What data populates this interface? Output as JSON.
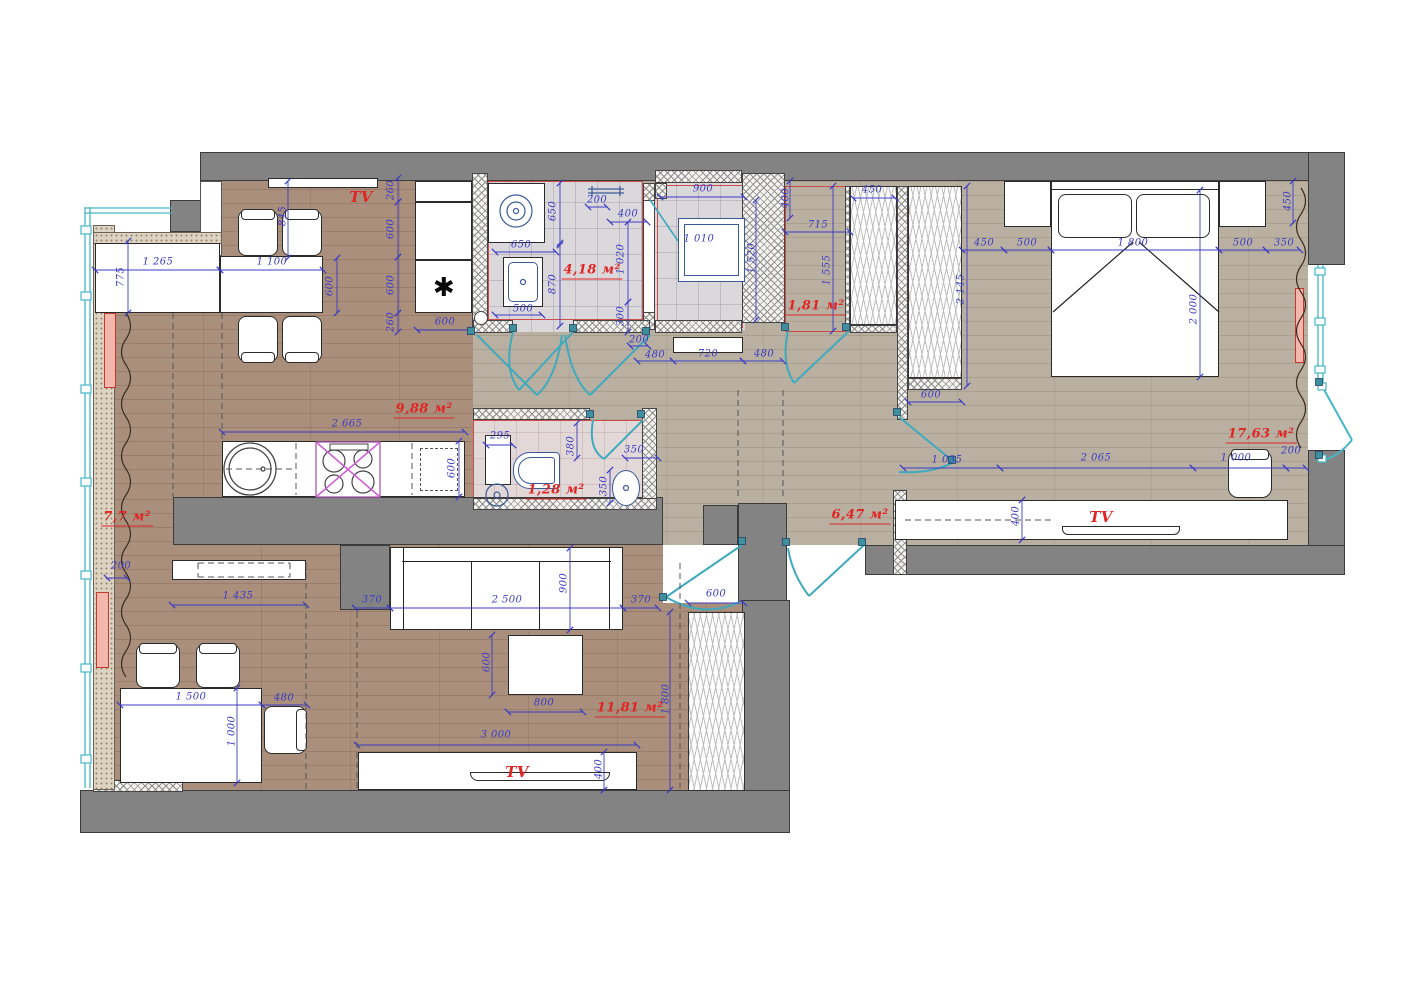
{
  "title": "Apartment furniture floor plan",
  "rooms": {
    "kitchen_dining": "9,88 м²",
    "bathroom": "4,18 м²",
    "wardrobe_room": "1,81 м²",
    "bedroom": "17,63 м²",
    "hallway": "6,47 м²",
    "wc": "1,28 м²",
    "loggia": "7,7 м²",
    "living_room": "11,81 м²"
  },
  "annotations": [
    [
      "845",
      283,
      216,
      -90,
      "d"
    ],
    [
      "1 265",
      158,
      262,
      0,
      "d"
    ],
    [
      "1 100",
      272,
      262,
      0,
      "d"
    ],
    [
      "775",
      121,
      277,
      -90,
      "d"
    ],
    [
      "600",
      330,
      286,
      -90,
      "d"
    ],
    [
      "260",
      391,
      190,
      -90,
      "d"
    ],
    [
      "600",
      391,
      229,
      -90,
      "d"
    ],
    [
      "600",
      391,
      285,
      -90,
      "d"
    ],
    [
      "260",
      391,
      322,
      -90,
      "d"
    ],
    [
      "600",
      445,
      322,
      0,
      "d"
    ],
    [
      "2 665",
      347,
      424,
      0,
      "d"
    ],
    [
      "600",
      452,
      468,
      -90,
      "d"
    ],
    [
      "650",
      553,
      211,
      -90,
      "d"
    ],
    [
      "650",
      521,
      245,
      0,
      "d"
    ],
    [
      "870",
      553,
      284,
      -90,
      "d"
    ],
    [
      "500",
      523,
      309,
      0,
      "d"
    ],
    [
      "200",
      597,
      200,
      0,
      "d"
    ],
    [
      "400",
      628,
      214,
      0,
      "d"
    ],
    [
      "1 020",
      621,
      259,
      -90,
      "d"
    ],
    [
      "300",
      621,
      316,
      -90,
      "d"
    ],
    [
      "900",
      703,
      189,
      0,
      "d"
    ],
    [
      "1 010",
      699,
      239,
      0,
      "d"
    ],
    [
      "1 520",
      752,
      258,
      -90,
      "d"
    ],
    [
      "200",
      639,
      340,
      0,
      "d"
    ],
    [
      "480",
      655,
      355,
      0,
      "d"
    ],
    [
      "720",
      708,
      354,
      0,
      "d"
    ],
    [
      "480",
      764,
      354,
      0,
      "d"
    ],
    [
      "400",
      786,
      198,
      -90,
      "d"
    ],
    [
      "450",
      872,
      190,
      0,
      "d"
    ],
    [
      "715",
      818,
      225,
      0,
      "d"
    ],
    [
      "1 555",
      827,
      270,
      -90,
      "d"
    ],
    [
      "450",
      984,
      243,
      0,
      "d"
    ],
    [
      "500",
      1027,
      243,
      0,
      "d"
    ],
    [
      "1 800",
      1133,
      243,
      0,
      "d"
    ],
    [
      "500",
      1243,
      243,
      0,
      "d"
    ],
    [
      "350",
      1284,
      243,
      0,
      "d"
    ],
    [
      "450",
      1288,
      201,
      -90,
      "d"
    ],
    [
      "2 145",
      961,
      289,
      -90,
      "d"
    ],
    [
      "2 000",
      1194,
      309,
      -90,
      "d"
    ],
    [
      "600",
      931,
      395,
      0,
      "d"
    ],
    [
      "1 035",
      947,
      460,
      0,
      "d"
    ],
    [
      "2 065",
      1096,
      458,
      0,
      "d"
    ],
    [
      "1 000",
      1236,
      458,
      0,
      "d"
    ],
    [
      "200",
      1291,
      451,
      0,
      "d"
    ],
    [
      "400",
      1016,
      516,
      -90,
      "d"
    ],
    [
      "295",
      500,
      436,
      0,
      "d"
    ],
    [
      "380",
      571,
      446,
      -90,
      "d"
    ],
    [
      "350",
      634,
      450,
      0,
      "d"
    ],
    [
      "350",
      604,
      486,
      -90,
      "d"
    ],
    [
      "200",
      121,
      566,
      0,
      "d"
    ],
    [
      "1 435",
      238,
      596,
      0,
      "d"
    ],
    [
      "370",
      372,
      600,
      0,
      "d"
    ],
    [
      "2 500",
      507,
      600,
      0,
      "d"
    ],
    [
      "900",
      564,
      583,
      -90,
      "d"
    ],
    [
      "370",
      641,
      600,
      0,
      "d"
    ],
    [
      "600",
      716,
      594,
      0,
      "d"
    ],
    [
      "600",
      487,
      662,
      -90,
      "d"
    ],
    [
      "800",
      544,
      703,
      0,
      "d"
    ],
    [
      "1 800",
      666,
      699,
      -90,
      "d"
    ],
    [
      "3 000",
      496,
      735,
      0,
      "d"
    ],
    [
      "400",
      599,
      769,
      -90,
      "d"
    ],
    [
      "1 500",
      191,
      697,
      0,
      "d"
    ],
    [
      "480",
      284,
      698,
      0,
      "d"
    ],
    [
      "1 000",
      232,
      731,
      -90,
      "d"
    ],
    [
      "9,88 м²",
      424,
      410,
      0,
      "a"
    ],
    [
      "4,18 м²",
      592,
      271,
      0,
      "a"
    ],
    [
      "1,81 м²",
      816,
      307,
      0,
      "a"
    ],
    [
      "17,63 м²",
      1261,
      435,
      0,
      "a"
    ],
    [
      "6,47 м²",
      860,
      516,
      0,
      "a"
    ],
    [
      "1,28 м²",
      556,
      491,
      0,
      "a"
    ],
    [
      "7,7 м²",
      127,
      518,
      0,
      "a"
    ],
    [
      "11,81 м²",
      630,
      709,
      0,
      "a"
    ],
    [
      "TV",
      361,
      197,
      0,
      "t"
    ],
    [
      "TV",
      1101,
      517,
      0,
      "t"
    ],
    [
      "TV",
      517,
      772,
      0,
      "t"
    ],
    [
      "✱",
      444,
      288,
      0,
      "m"
    ]
  ],
  "dim_lines": [
    [
      95,
      270,
      220,
      270
    ],
    [
      220,
      270,
      323,
      270
    ],
    [
      417,
      330,
      472,
      330
    ],
    [
      222,
      432,
      465,
      432
    ],
    [
      495,
      252,
      556,
      252
    ],
    [
      495,
      315,
      542,
      315
    ],
    [
      588,
      207,
      607,
      207
    ],
    [
      610,
      222,
      647,
      222
    ],
    [
      660,
      197,
      744,
      197
    ],
    [
      630,
      346,
      648,
      346
    ],
    [
      637,
      361,
      673,
      361
    ],
    [
      673,
      361,
      743,
      361
    ],
    [
      743,
      361,
      783,
      361
    ],
    [
      785,
      232,
      850,
      232
    ],
    [
      853,
      198,
      895,
      198
    ],
    [
      962,
      250,
      1004,
      250
    ],
    [
      1004,
      250,
      1051,
      250
    ],
    [
      1051,
      250,
      1219,
      250
    ],
    [
      1219,
      250,
      1266,
      250
    ],
    [
      1266,
      250,
      1300,
      250
    ],
    [
      908,
      402,
      962,
      402
    ],
    [
      903,
      468,
      1000,
      468
    ],
    [
      1000,
      468,
      1193,
      468
    ],
    [
      1193,
      468,
      1286,
      468
    ],
    [
      1286,
      468,
      1306,
      468
    ],
    [
      120,
      705,
      262,
      705
    ],
    [
      262,
      705,
      307,
      705
    ],
    [
      172,
      605,
      306,
      605
    ],
    [
      355,
      608,
      390,
      608
    ],
    [
      390,
      608,
      623,
      608
    ],
    [
      623,
      608,
      658,
      608
    ],
    [
      688,
      603,
      744,
      603
    ],
    [
      508,
      712,
      583,
      712
    ],
    [
      357,
      745,
      637,
      745
    ],
    [
      107,
      578,
      127,
      578
    ],
    [
      625,
      458,
      658,
      458
    ],
    [
      486,
      445,
      513,
      445
    ],
    [
      288,
      181,
      288,
      258
    ],
    [
      128,
      241,
      128,
      313
    ],
    [
      337,
      258,
      337,
      313
    ],
    [
      398,
      178,
      398,
      202
    ],
    [
      398,
      202,
      398,
      257
    ],
    [
      398,
      257,
      398,
      313
    ],
    [
      398,
      313,
      398,
      332
    ],
    [
      459,
      441,
      459,
      497
    ],
    [
      560,
      183,
      560,
      243
    ],
    [
      560,
      245,
      560,
      326
    ],
    [
      628,
      222,
      628,
      302
    ],
    [
      628,
      302,
      628,
      332
    ],
    [
      756,
      200,
      756,
      320
    ],
    [
      790,
      181,
      790,
      218
    ],
    [
      833,
      186,
      833,
      331
    ],
    [
      967,
      186,
      967,
      386
    ],
    [
      1293,
      181,
      1293,
      223
    ],
    [
      1200,
      190,
      1200,
      377
    ],
    [
      1022,
      500,
      1022,
      540
    ],
    [
      570,
      548,
      570,
      630
    ],
    [
      492,
      635,
      492,
      695
    ],
    [
      670,
      612,
      670,
      790
    ],
    [
      604,
      752,
      604,
      790
    ],
    [
      237,
      688,
      237,
      783
    ],
    [
      577,
      423,
      577,
      458
    ],
    [
      610,
      470,
      610,
      503
    ]
  ],
  "dashed_lines": [
    [
      173,
      313,
      173,
      497
    ],
    [
      222,
      313,
      222,
      441
    ],
    [
      306,
      563,
      306,
      790
    ],
    [
      357,
      612,
      357,
      790
    ],
    [
      680,
      563,
      680,
      788
    ],
    [
      738,
      390,
      738,
      500
    ],
    [
      783,
      390,
      783,
      500
    ],
    [
      296,
      443,
      296,
      495
    ],
    [
      412,
      443,
      412,
      495
    ],
    [
      226,
      469,
      292,
      469
    ],
    [
      905,
      520,
      1052,
      520
    ],
    [
      198,
      563,
      290,
      563
    ],
    [
      198,
      577,
      290,
      577
    ],
    [
      198,
      563,
      198,
      577
    ],
    [
      290,
      563,
      290,
      577
    ]
  ],
  "door_posts": [
    [
      513,
      328
    ],
    [
      573,
      328
    ],
    [
      590,
      414
    ],
    [
      641,
      414
    ],
    [
      471,
      331
    ],
    [
      646,
      331
    ],
    [
      785,
      327
    ],
    [
      846,
      327
    ],
    [
      742,
      541
    ],
    [
      663,
      597
    ],
    [
      862,
      542
    ],
    [
      786,
      542
    ],
    [
      897,
      412
    ],
    [
      952,
      460
    ],
    [
      1319,
      382
    ],
    [
      1319,
      455
    ]
  ],
  "colors": {
    "wall": "#838383",
    "dimension": "#3b3bc4",
    "room_label": "#e02525",
    "door": "#3fa9bd",
    "floor_wood": "#aa8f7d",
    "floor_hall": "#b9b0a2",
    "stove_mark": "#cf5fd4"
  }
}
